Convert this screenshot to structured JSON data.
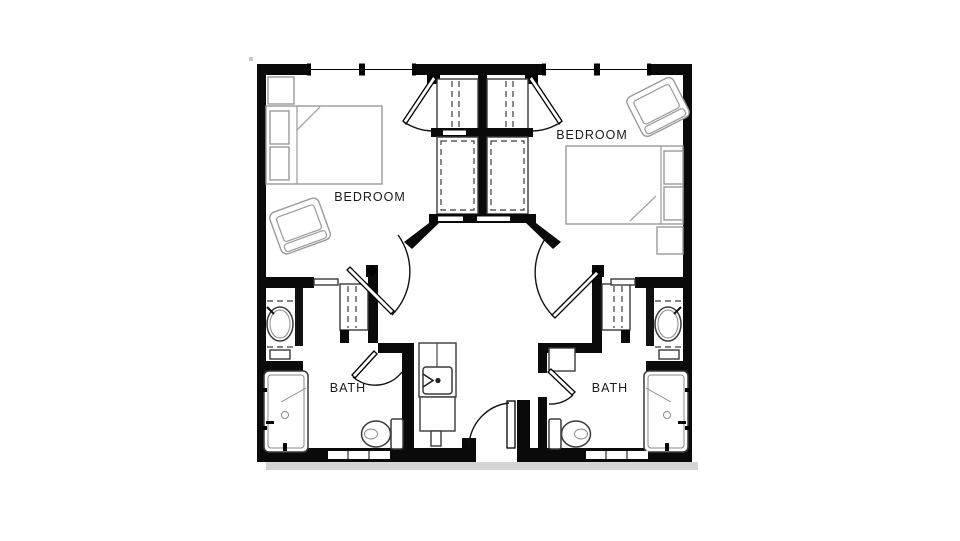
{
  "canvas": {
    "width": 960,
    "height": 541,
    "background": "#ffffff"
  },
  "floor_plan": {
    "rooms": [
      {
        "id": "bedroom-left",
        "label": "BEDROOM"
      },
      {
        "id": "bedroom-right",
        "label": "BEDROOM"
      },
      {
        "id": "bath-left",
        "label": "BATH"
      },
      {
        "id": "bath-right",
        "label": "BATH"
      }
    ],
    "colors": {
      "wall": "#0a0a0a",
      "furniture_line": "#9a9a9a",
      "fixture_line": "#3a3a3a",
      "shadow": "#d5d5d5",
      "label_text": "#1a1a1a",
      "background": "#ffffff"
    },
    "fixtures": {
      "bedrooms": [
        "double-bed",
        "pillows",
        "nightstand",
        "lounge-chair",
        "closet-with-rod",
        "window",
        "swing-door"
      ],
      "baths": [
        "roll-in-shower",
        "toilet",
        "oval-vanity-sink",
        "linen-closet",
        "swing-door",
        "grab-bars"
      ],
      "vestibule": [
        "entry-swing-door",
        "sink-cabinet",
        "base-cabinet",
        "wardrobe-closets"
      ]
    }
  }
}
